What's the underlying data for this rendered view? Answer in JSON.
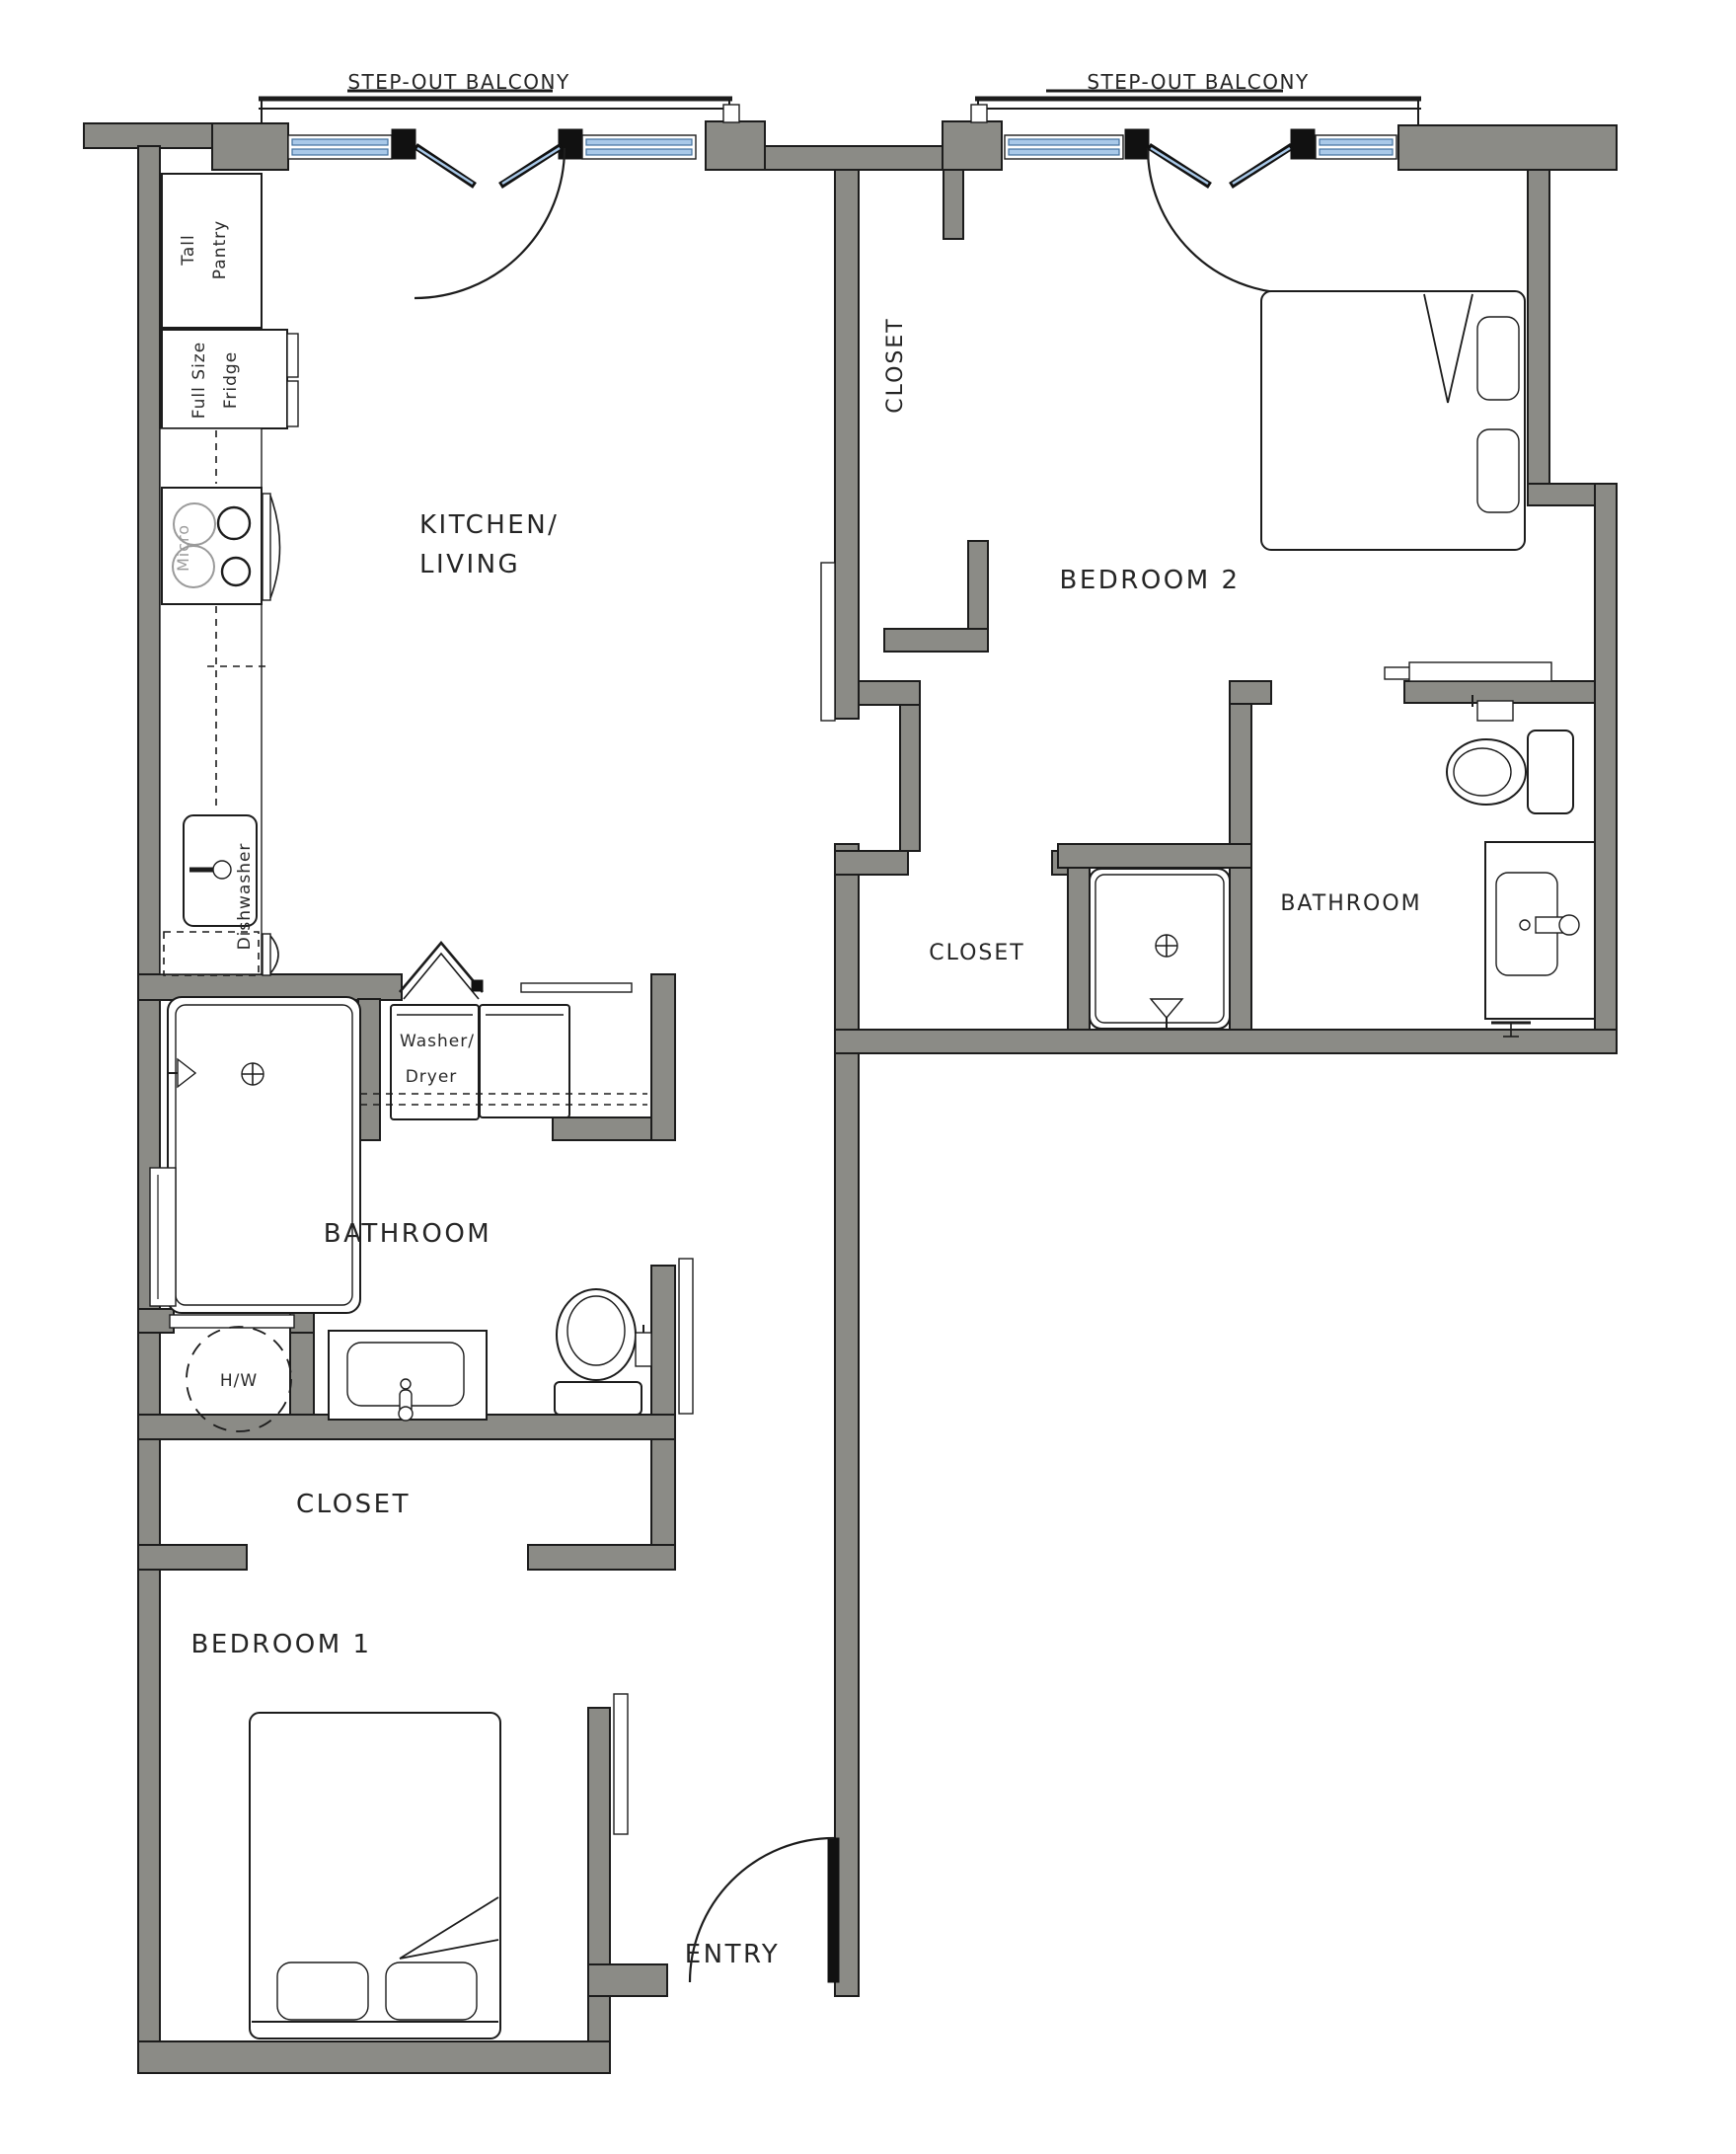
{
  "document": {
    "type": "floor-plan",
    "unit_layout": "2 bedroom / 2 bathroom apartment"
  },
  "colors": {
    "wall_fill": "#8b8b86",
    "line": "#1c1c1c",
    "window_glass": "#a9c9e9",
    "window_frame": "#44719f",
    "appliance_gray": "#9a9a9a",
    "background": "#ffffff"
  },
  "labels": {
    "balcony1": "STEP-OUT BALCONY",
    "balcony2": "STEP-OUT BALCONY",
    "kitchen_line1": "KITCHEN/",
    "kitchen_line2": "LIVING",
    "bedroom2": "BEDROOM 2",
    "closet_bedroom2": "CLOSET",
    "closet_hall": "CLOSET",
    "bathroom2": "BATHROOM",
    "bathroom1": "BATHROOM",
    "closet1": "CLOSET",
    "bedroom1": "BEDROOM 1",
    "entry": "ENTRY",
    "tall_pantry_line1": "Tall",
    "tall_pantry_line2": "Pantry",
    "fridge_line1": "Full Size",
    "fridge_line2": "Fridge",
    "micro": "Micro",
    "dishwasher": "Dishwasher",
    "washer_line1": "Washer/",
    "washer_line2": "Dryer",
    "water_heater": "H/W"
  }
}
